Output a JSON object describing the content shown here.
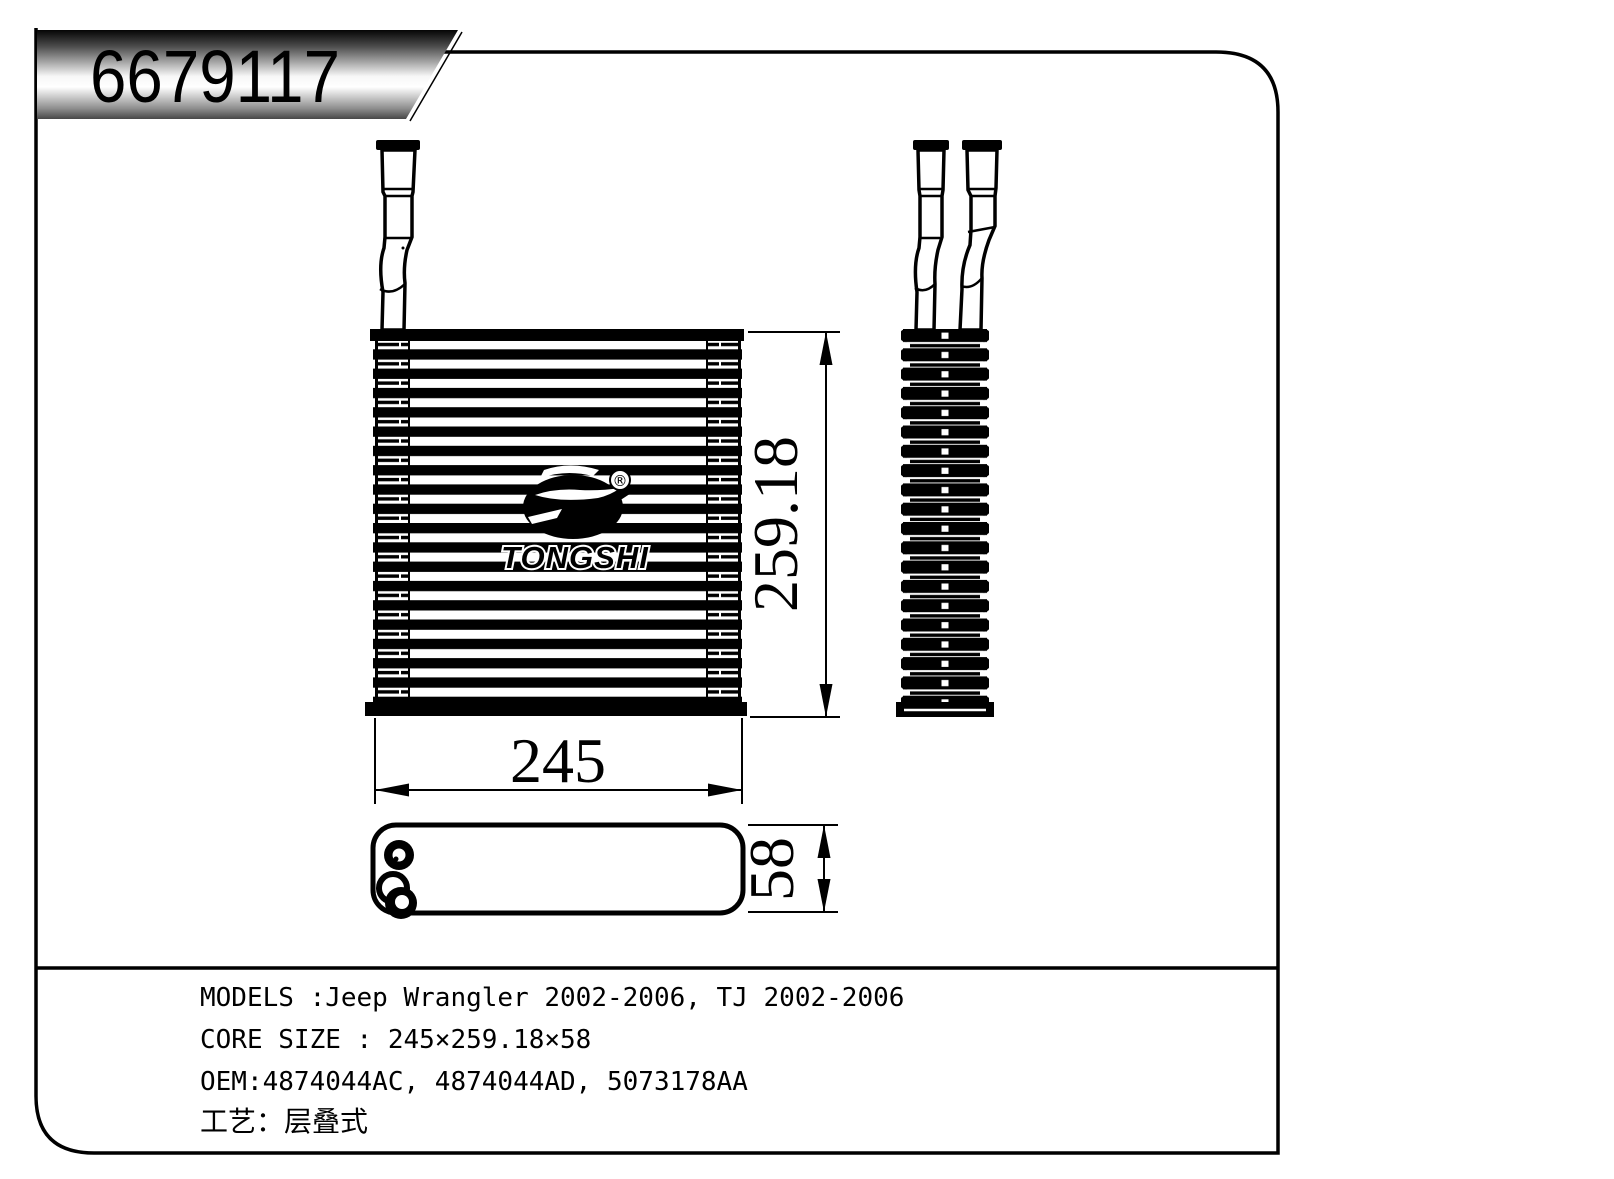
{
  "colors": {
    "ink": "#000000",
    "paper": "#ffffff"
  },
  "title_block": {
    "part_number": "6679117"
  },
  "logo": {
    "brand": "TONGSHI",
    "registered_mark": "®"
  },
  "dimensions": {
    "core_height": "259.18",
    "core_width": "245",
    "core_depth": "58"
  },
  "specs": {
    "models": "MODELS :Jeep Wrangler 2002-2006, TJ 2002-2006",
    "core_size": "CORE SIZE : 245×259.18×58",
    "oem": "OEM:4874044AC,  4874044AD,  5073178AA",
    "process": "工艺：层叠式"
  }
}
